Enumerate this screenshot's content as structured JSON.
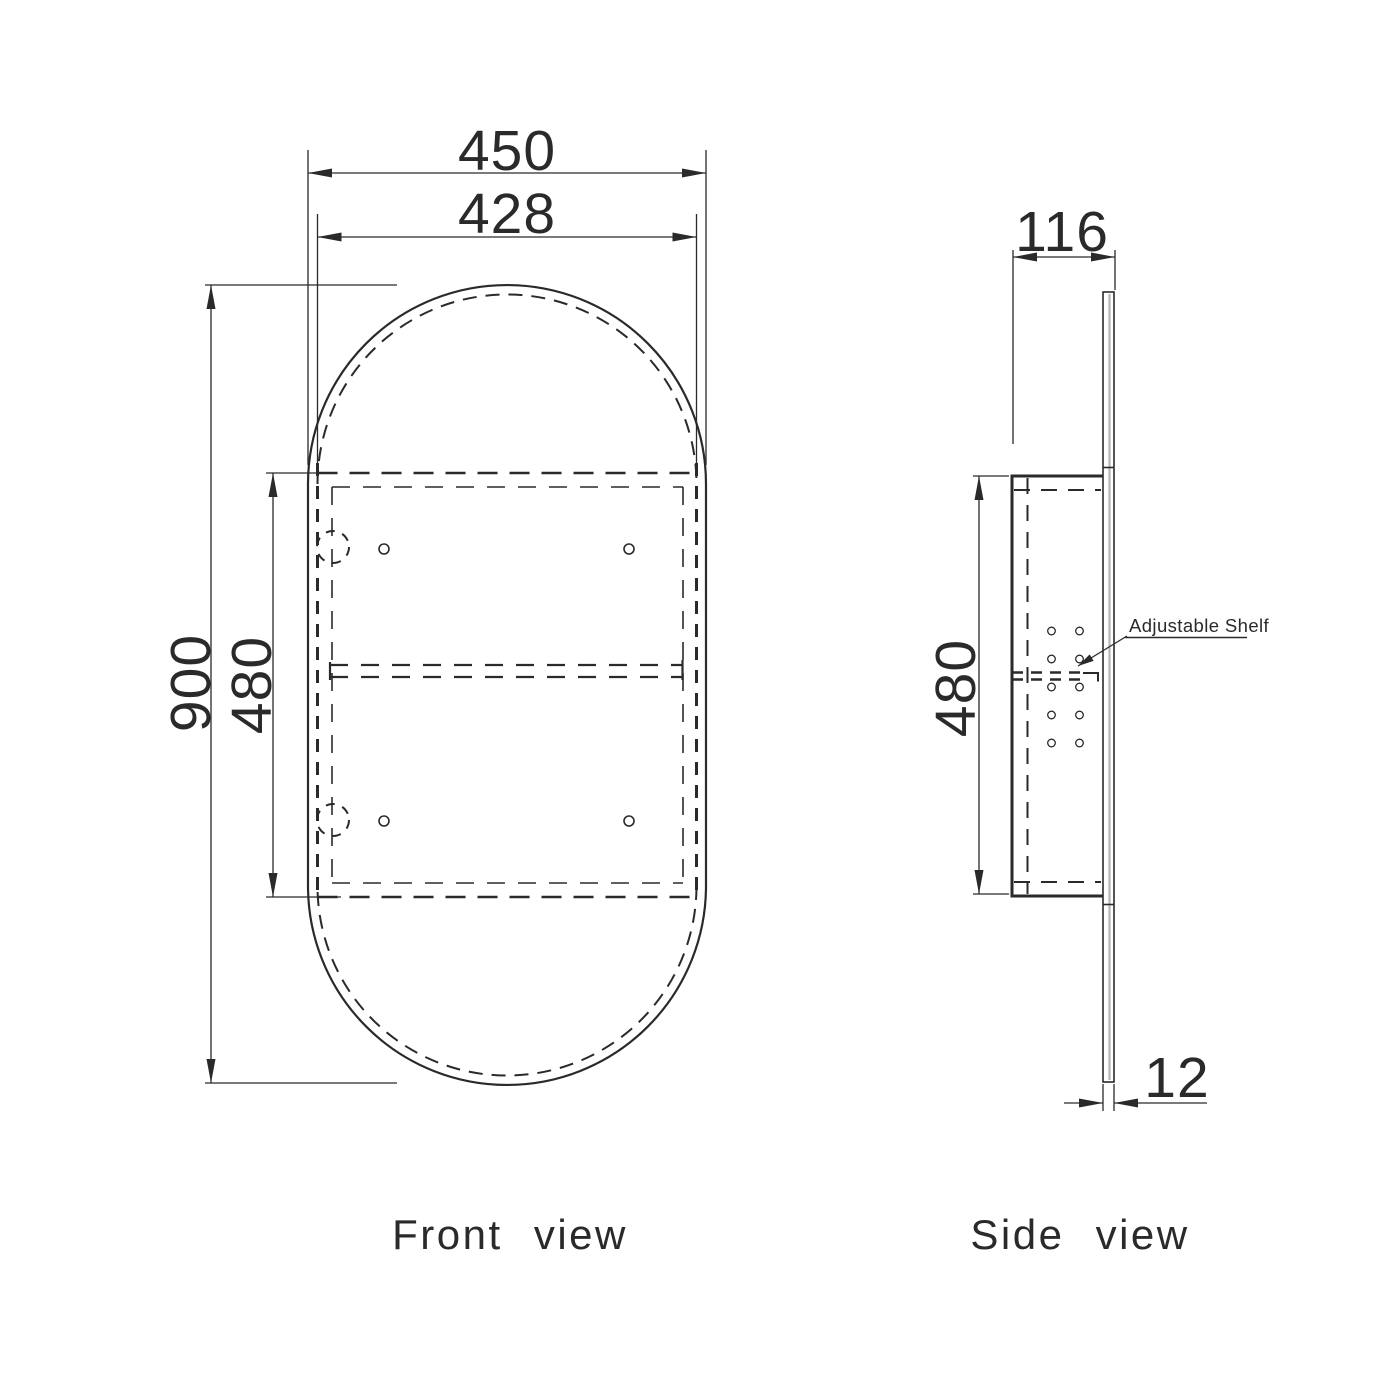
{
  "page": {
    "background_color": "#ffffff",
    "line_color": "#2a2a2a"
  },
  "drawing": {
    "front": {
      "label": "Front view",
      "dims": {
        "width_overall": "450",
        "width_inner": "428",
        "height_overall": "900",
        "cabinet_height": "480"
      }
    },
    "side": {
      "label": "Side view",
      "dims": {
        "depth": "116",
        "cabinet_height": "480",
        "mirror_thickness": "12"
      },
      "shelf_note": "Adjustable Shelf"
    }
  }
}
